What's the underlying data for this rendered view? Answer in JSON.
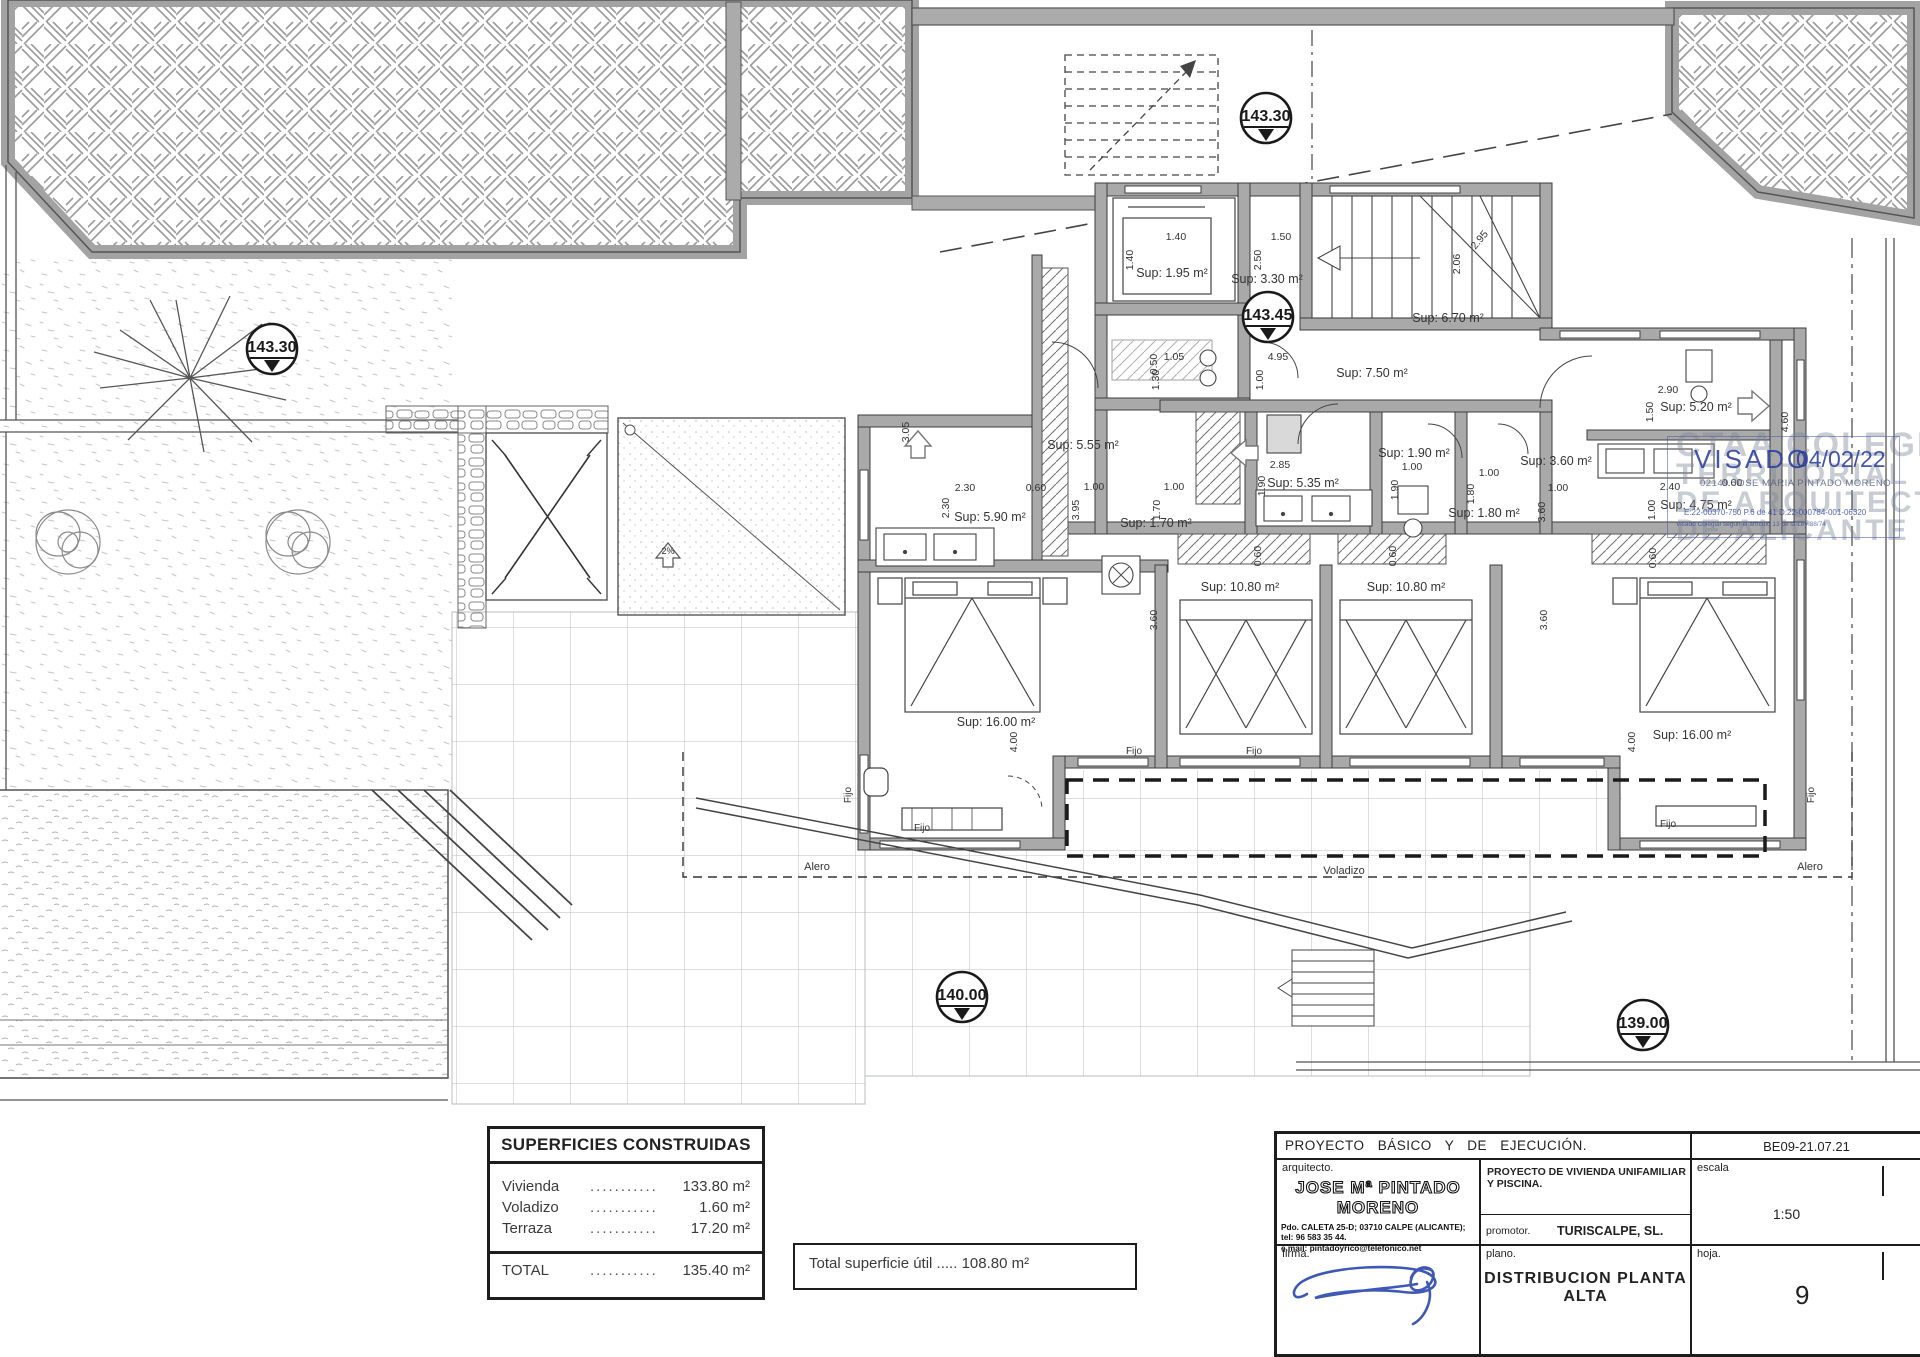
{
  "drawing": {
    "type": "architectural-floor-plan",
    "levels": [
      "143.30",
      "143.30",
      "143.45",
      "140.00",
      "139.00"
    ],
    "room_labels": [
      "Sup: 1.95 m²",
      "Sup: 3.30 m²",
      "Sup: 6.70 m²",
      "Sup: 7.50 m²",
      "Sup: 5.55 m²",
      "Sup: 5.90 m²",
      "Sup: 5.35 m²",
      "Sup: 1.90 m²",
      "Sup: 1.70 m²",
      "Sup: 1.80 m²",
      "Sup: 3.60 m²",
      "Sup: 5.20 m²",
      "Sup: 4.75 m²",
      "Sup: 10.80 m²",
      "Sup: 10.80 m²",
      "Sup: 16.00 m²",
      "Sup: 16.00 m²"
    ],
    "dims": [
      "1.40",
      "1.50",
      "1.40",
      "2.50",
      "2.95",
      "2.06",
      "1.05",
      "1.30",
      "4.95",
      "1.00",
      "3.05",
      "2.85",
      "1.90",
      "1.00",
      "1.90",
      "1.00",
      "1.80",
      "1.00",
      "3.95",
      "1.00",
      "1.70",
      "2.30",
      "2.30",
      "0.60",
      "2.90",
      "1.50",
      "1.00",
      "3.60",
      "2.40",
      "1.00",
      "0.60",
      "3.60",
      "3.60",
      "4.00",
      "4.00",
      "0.60",
      "0.60",
      "0.60",
      "0.50",
      "4.60"
    ],
    "fijo": "Fijo",
    "alero": "Alero",
    "voladizo": "Voladizo",
    "slope": "2%"
  },
  "areas_table": {
    "title": "SUPERFICIES CONSTRUIDAS",
    "dots": "............",
    "rows": [
      {
        "label": "Vivienda",
        "value": "133.80 m²"
      },
      {
        "label": "Voladizo",
        "value": "1.60 m²"
      },
      {
        "label": "Terraza",
        "value": "17.20 m²"
      }
    ],
    "total_label": "TOTAL",
    "total_value": "135.40 m²"
  },
  "useful_area_text": "Total superficie útil ..... 108.80 m²",
  "title_block": {
    "project": "PROYECTO BÁSICO Y DE EJECUCIÓN.",
    "code": "BE09-21.07.21",
    "arch_label": "arquitecto.",
    "architect": "JOSE Mª PINTADO MORENO",
    "address": "Pdo. CALETA 25-D; 03710 CALPE (ALICANTE); tel: 96 583 35 44.",
    "email": "e.mail: pintadoyrico@telefonico.net",
    "desc": "PROYECTO DE VIVIENDA UNIFAMILIAR Y PISCINA.",
    "promotor_label": "promotor.",
    "promotor": "TURISCALPE, SL.",
    "escala_label": "escala",
    "escala": "1:50",
    "firma_label": "firma.",
    "plano_label": "plano.",
    "plano": "DISTRIBUCION PLANTA ALTA",
    "hoja_label": "hoja.",
    "hoja": "9"
  },
  "stamp": {
    "org": "CTAA",
    "wm1": "COLEGIO",
    "wm2": "TERRITORIAL",
    "wm3": "DE ARQUITECTOS",
    "wm4": "DE ALICANTE",
    "visado": "VISADO",
    "date": "04/02/22",
    "number": "02149 JOSE MARIA PINTADO MORENO",
    "refs": "E:22-00370-750     P.6 de 41     D:22-000784-001-06320",
    "fine": "Visado Colegial según el artículo 13 de la Ley 38/74"
  }
}
